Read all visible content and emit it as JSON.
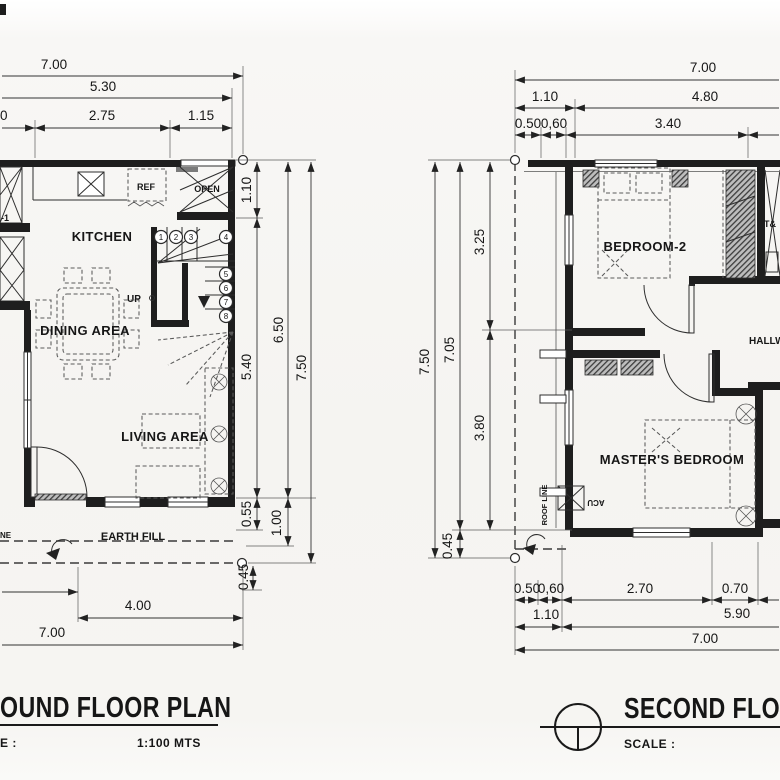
{
  "ground_floor": {
    "title": "OUND FLOOR PLAN",
    "scale_label": "E :",
    "scale_value": "1:100 MTS",
    "rooms": {
      "kitchen": "KITCHEN",
      "dining": "DINING AREA",
      "living": "LIVING AREA",
      "ref": "REF",
      "open": "OPEN",
      "up": "UP",
      "earth_fill": "EARTH FILL",
      "room1_partial": "-1",
      "line_partial": "NE"
    },
    "stair_steps": [
      "1",
      "2",
      "3",
      "4",
      "5",
      "6",
      "7",
      "8"
    ],
    "dim_top": [
      "7.00",
      "5.30",
      "0",
      "2.75",
      "1.15"
    ],
    "dim_right": [
      "1.10",
      "5.40",
      "0.55",
      "0.45",
      "6.50",
      "1.00",
      "7.50"
    ],
    "dim_bottom": [
      "4.00",
      "7.00"
    ]
  },
  "second_floor": {
    "title": "SECOND FLOOR",
    "scale_label": "SCALE :",
    "rooms": {
      "bedroom2": "BEDROOM-2",
      "master": "MASTER'S BEDROOM",
      "hallway": "HALLWAY",
      "toilet": "T&",
      "acu": "ACU",
      "roof_line": "ROOF LINE"
    },
    "dim_top": [
      "7.00",
      "1.10",
      "4.80",
      "0.50",
      "0,60",
      "3.40"
    ],
    "dim_left": [
      "7.50",
      "7.05",
      "0.45",
      "3.25",
      "3.80"
    ],
    "dim_bottom": [
      "0.50",
      "0,60",
      "2.70",
      "0.70",
      "1.10",
      "5.90",
      "7.00"
    ]
  }
}
